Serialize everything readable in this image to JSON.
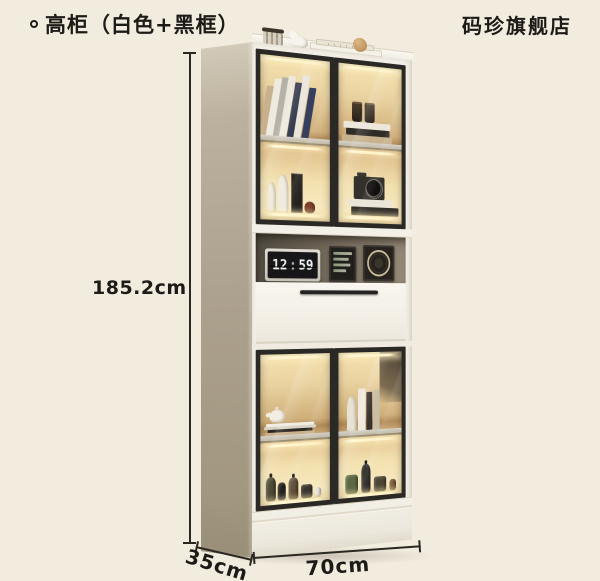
{
  "header": {
    "bullet_icon": "circle-outline",
    "title": "高柜（白色+黑框）",
    "store_name": "码珍旗舰店"
  },
  "dimensions": {
    "height": "185.2cm",
    "width": "70cm",
    "depth": "35cm"
  },
  "cabinet": {
    "clock": {
      "hours": "12",
      "separator": ":",
      "minutes": "59"
    },
    "top_decor_items": [
      "glass-jar",
      "bird-figurine",
      "white-tray-with-book",
      "wooden-ball"
    ],
    "upper_cabinet": {
      "left_door_items": [
        "leaning-books",
        "white-vases",
        "framed-art",
        "red-ornament"
      ],
      "right_door_items": [
        "two-dark-cups",
        "stacked-books",
        "camera-on-books"
      ]
    },
    "open_shelf_items": [
      "flip-clock",
      "digital-calendar",
      "round-emblem-frame"
    ],
    "lower_cabinet": {
      "left_door_items": [
        "white-teapot",
        "stacked-books",
        "bottle-collection"
      ],
      "right_door_items": [
        "standing-books",
        "white-cylinder",
        "bottle-collection"
      ]
    },
    "colors": {
      "background": "#f2ecdf",
      "cabinet_body": "#f3f0e8",
      "side_panel": "#b2a794",
      "door_frame": "#2b2926",
      "interior_glow": "#f2dfae",
      "niche_back": "#6e6557",
      "shelf_board": "#c4c0b6",
      "handle": "#262422",
      "dimension_line": "#2b2822",
      "text": "#1d1b17"
    }
  }
}
